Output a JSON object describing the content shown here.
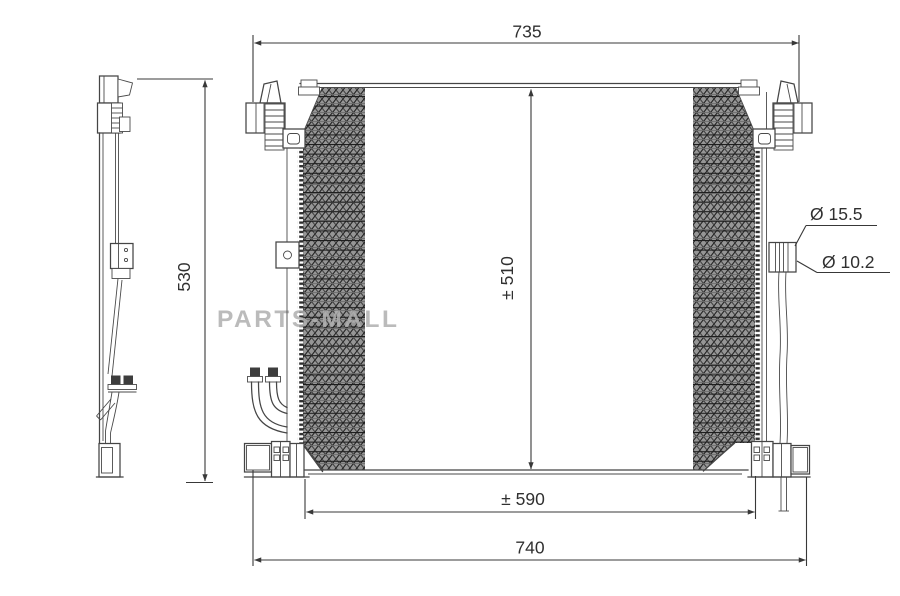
{
  "drawing": {
    "watermark": "PARTS-MALL",
    "dimensions": {
      "top_width": "735",
      "left_height": "530",
      "core_height": "± 510",
      "core_width": "± 590",
      "bottom_width": "740"
    },
    "callouts": {
      "port_large": "Ø 15.5",
      "port_small": "Ø 10.2"
    },
    "colors": {
      "line": "#454545",
      "dimension_text": "#303030",
      "watermark": "#b0b0b0",
      "background": "#ffffff",
      "core_hatch": "#2b2b2b"
    }
  }
}
